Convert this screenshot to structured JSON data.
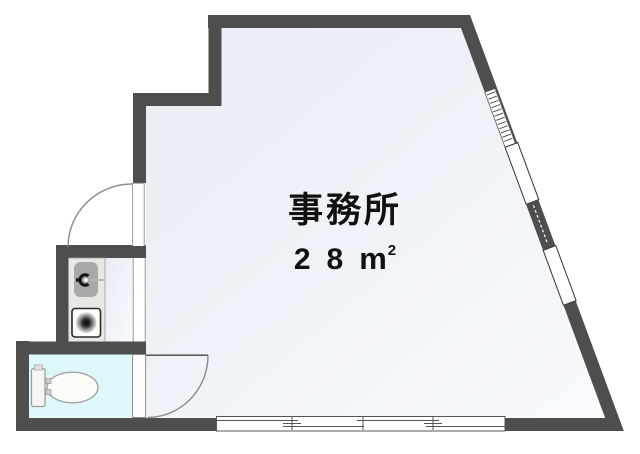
{
  "floorplan": {
    "room": {
      "label": "事務所",
      "area_number": "28",
      "area_unit_letter": "m",
      "area_unit_exponent": "2"
    },
    "colors": {
      "wall": "#4e4e4e",
      "floor_start": "#e9edf4",
      "floor_end": "#f8fafc",
      "toilet_floor": "#def7fa",
      "counter": "#e7e7e4",
      "sink_basin": "#a8a8a8",
      "text": "#111111"
    }
  }
}
